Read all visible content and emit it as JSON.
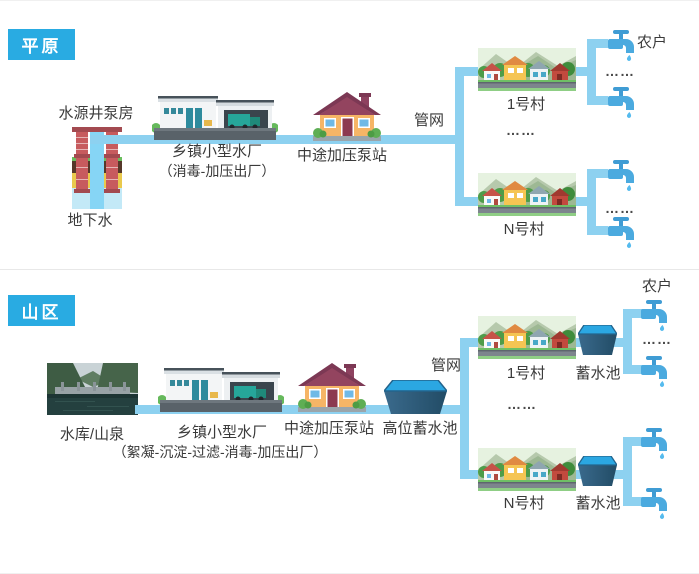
{
  "colors": {
    "pipe": "#8DD1F0",
    "badge": "#29ABE2",
    "text": "#3A3A3A",
    "faucet": "#4BAADF",
    "pool_water": "#2BA7E2"
  },
  "icons": [
    "well-icon",
    "water-plant-icon",
    "pump-house-icon",
    "village-icon",
    "faucet-icon",
    "reservoir-photo",
    "storage-pool-icon",
    "pipe-line"
  ],
  "plain": {
    "badge": "平原",
    "well_label": "水源井泵房",
    "groundwater_label": "地下水",
    "plant_label": "乡镇小型水厂",
    "plant_process": "（消毒-加压出厂）",
    "pump_label": "中途加压泵站",
    "network_label": "管网",
    "village1_label": "1号村",
    "villageN_label": "N号村",
    "household_label": "农户",
    "ellipsis": "……"
  },
  "mountain": {
    "badge": "山区",
    "source_label": "水库/山泉",
    "plant_label": "乡镇小型水厂",
    "plant_process": "（絮凝-沉淀-过滤-消毒-加压出厂）",
    "pump_label": "中途加压泵站",
    "high_tank_label": "高位蓄水池",
    "network_label": "管网",
    "village1_label": "1号村",
    "villageN_label": "N号村",
    "tank_label": "蓄水池",
    "household_label": "农户",
    "ellipsis": "……"
  }
}
